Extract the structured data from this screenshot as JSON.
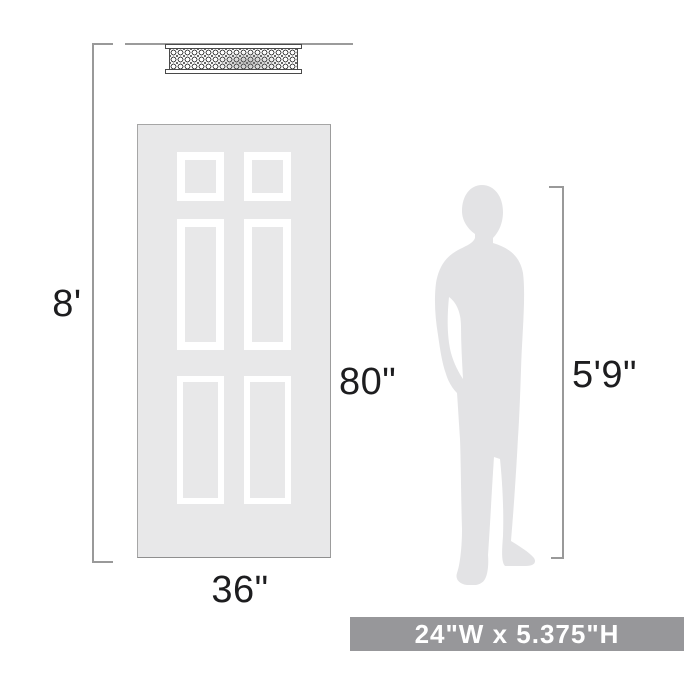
{
  "diagram": {
    "title": "product-scale-reference",
    "ceiling_height_label": "8'",
    "door_height_label": "80\"",
    "door_width_label": "36\"",
    "person_height_label": "5'9\"",
    "banner_text": "24\"W x 5.375\"H"
  },
  "illustrations": {
    "fixture": "caged-flush-mount-light",
    "door": "six-panel-door",
    "person": "standing-man-silhouette"
  },
  "colors": {
    "background": "#ffffff",
    "door_fill": "#e8e8e9",
    "door_border": "#a6a6a6",
    "panel_frame": "#ffffff",
    "silhouette_fill": "#e3e3e5",
    "dimension_line": "#999999",
    "label_text": "#1d1d1f",
    "banner_background": "#97979a",
    "banner_text_color": "#ffffff",
    "fixture_line_color": "#4a4a4a"
  }
}
